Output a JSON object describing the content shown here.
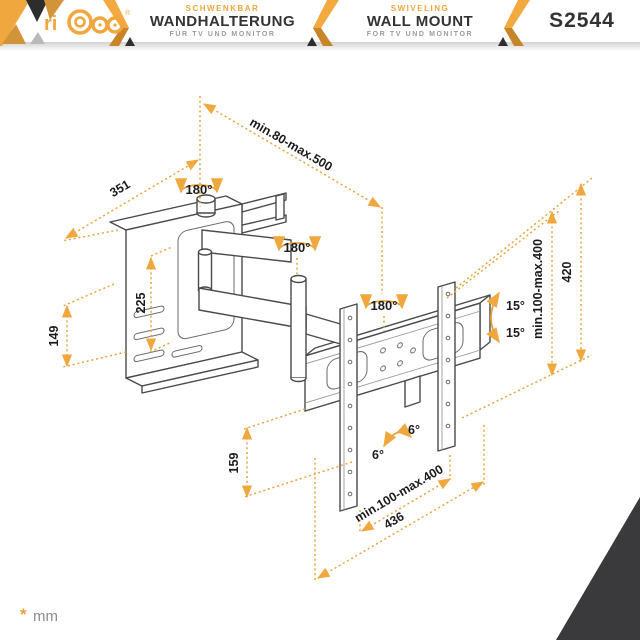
{
  "header": {
    "brand": {
      "name": "ricoo",
      "registered": "®"
    },
    "sections": [
      {
        "tagline": "SCHWENKBAR",
        "title": "WANDHALTERUNG",
        "subtitle": "FÜR TV UND MONITOR"
      },
      {
        "tagline": "SWIVELING",
        "title": "WALL MOUNT",
        "subtitle": "FOR TV UND MONITOR"
      }
    ],
    "model": "S2544",
    "accent_color": "#EFA73E"
  },
  "diagram": {
    "type": "technical-drawing",
    "product": "full-motion TV wall mount",
    "unit_note": {
      "symbol": "*",
      "unit": "mm"
    },
    "labels": {
      "wall_plate_width": "351",
      "wall_plate_slot_height": "225",
      "wall_plate_height": "149",
      "arm_extension": "min.80-max.500",
      "swivel_wall": "180°",
      "swivel_arm": "180°",
      "swivel_tv": "180°",
      "tilt_up": "15°",
      "tilt_down": "15°",
      "level_left": "6°",
      "level_right": "6°",
      "vesa_vertical": "min.100-max.400",
      "bracket_height": "420",
      "bracket_depth": "159",
      "vesa_horizontal": "min.100-max.400",
      "bracket_width": "436"
    },
    "colors": {
      "dimension_accent": "#E8A33D",
      "drawing_line": "#4a4a4a",
      "corner_triangle": "#3a3a3c"
    }
  }
}
